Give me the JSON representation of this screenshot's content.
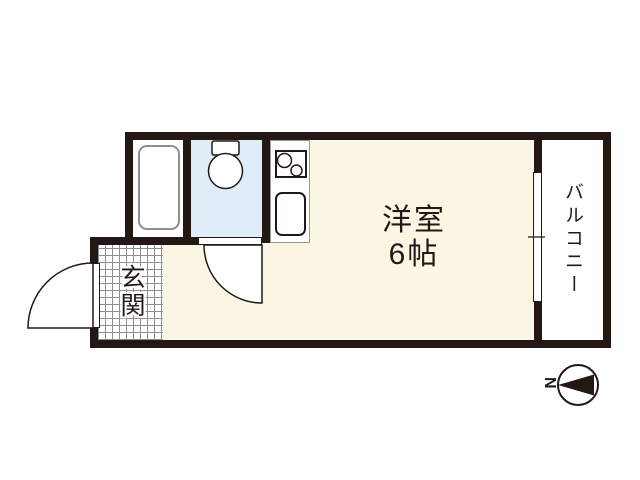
{
  "floorplan": {
    "rooms": {
      "main_room": {
        "name": "洋室",
        "size": "6帖"
      },
      "entrance": {
        "label": "玄関"
      },
      "balcony": {
        "label": "バルコニー"
      }
    },
    "compass": {
      "north_label": "N",
      "direction": "north-points-left"
    },
    "fixtures": {
      "bathtub": "bathtub-icon",
      "toilet": "toilet-icon",
      "stove": "stove-two-burner-icon",
      "sink": "kitchen-sink-icon",
      "entry_door": "door-swing-icon",
      "toilet_door": "door-swing-icon",
      "balcony_window": "sliding-window-icon"
    },
    "colors": {
      "wall": "#231815",
      "room_floor": "#FAF6E3",
      "toilet_room_floor": "#DEEDF8",
      "fixture_outline": "#999999",
      "background": "#FFFFFF"
    }
  }
}
